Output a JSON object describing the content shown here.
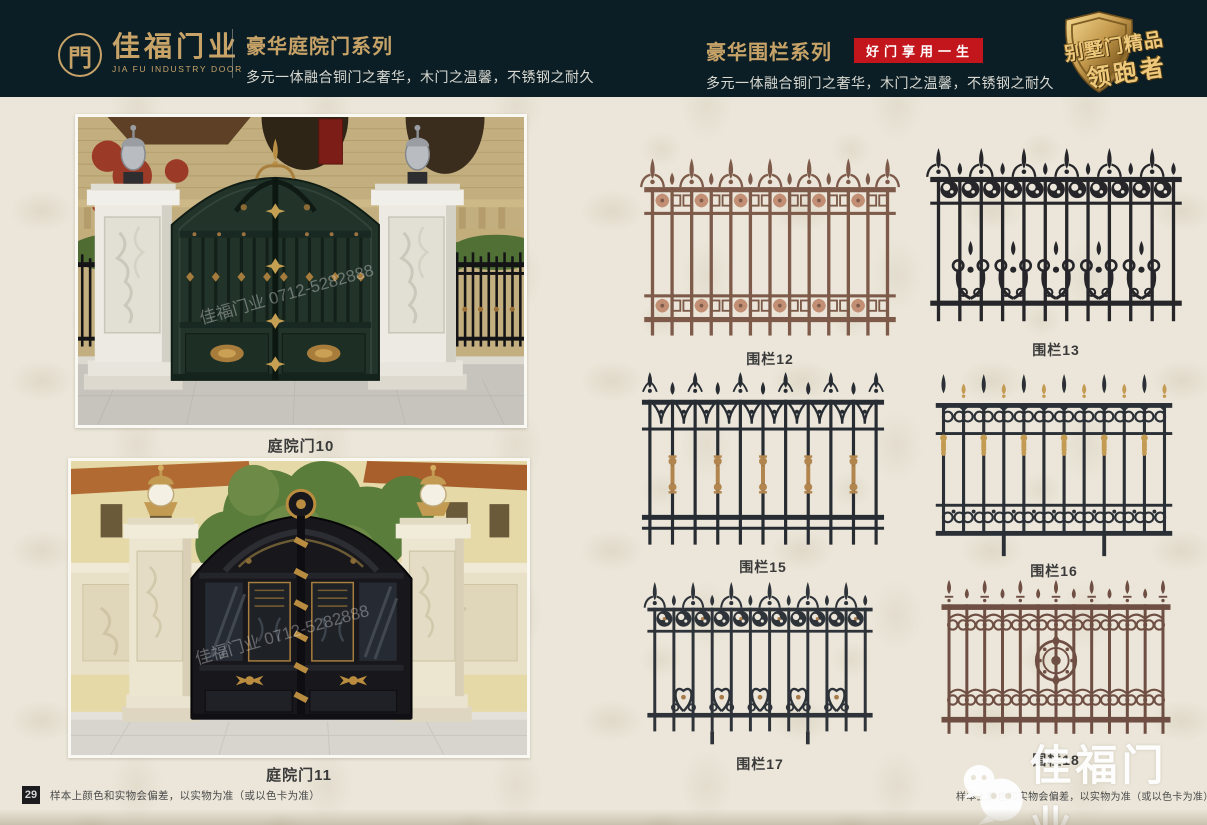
{
  "header": {
    "logo": {
      "symbol": "門",
      "brand": "佳福门业",
      "brand_en": "JIA FU INDUSTRY DOOR"
    },
    "left_series": {
      "title": "豪华庭院门系列",
      "subtitle": "多元一体融合铜门之奢华，木门之温馨，不锈钢之耐久"
    },
    "right_series": {
      "title": "豪华围栏系列",
      "badge": "好门享用一生",
      "subtitle": "多元一体融合铜门之奢华，木门之温馨，不锈钢之耐久"
    },
    "emblem": {
      "line1": "别墅门精品",
      "line2": "领跑者"
    }
  },
  "gates": [
    {
      "label": "庭院门10"
    },
    {
      "label": "庭院门11"
    }
  ],
  "fences": [
    {
      "label": "围栏12",
      "style": "copper-rosette",
      "color": "#7d5a49",
      "accent": "#c28f74"
    },
    {
      "label": "围栏13",
      "style": "swirl-scroll",
      "color": "#26262a",
      "accent": "#3a3a40"
    },
    {
      "label": "围栏15",
      "style": "fleur-spindle",
      "color": "#272c33",
      "accent": "#b2854e"
    },
    {
      "label": "围栏16",
      "style": "swan-gold",
      "color": "#2b3037",
      "accent": "#c49b52"
    },
    {
      "label": "围栏17",
      "style": "circle-heart",
      "color": "#2e333a",
      "accent": "#a87a47"
    },
    {
      "label": "围栏18",
      "style": "heart-medallion",
      "color": "#6f4e43",
      "accent": "#8a655a"
    }
  ],
  "footer": {
    "left_page": "29",
    "right_page": "30",
    "disclaimer": "样本上颜色和实物会偏差，以实物为准（或以色卡为准）"
  },
  "watermark": {
    "photo_text": "佳福门业 0712-5282888",
    "corner_brand": "佳福门业"
  },
  "colors": {
    "header_bg": "#0c1e25",
    "gold": "#c7a368",
    "red_badge": "#c3161c",
    "page_bg": "#ebe6d9",
    "label_text": "#3a3a3a",
    "footer_text": "#4a4a4a",
    "badge_bg": "#1c1c1e"
  }
}
